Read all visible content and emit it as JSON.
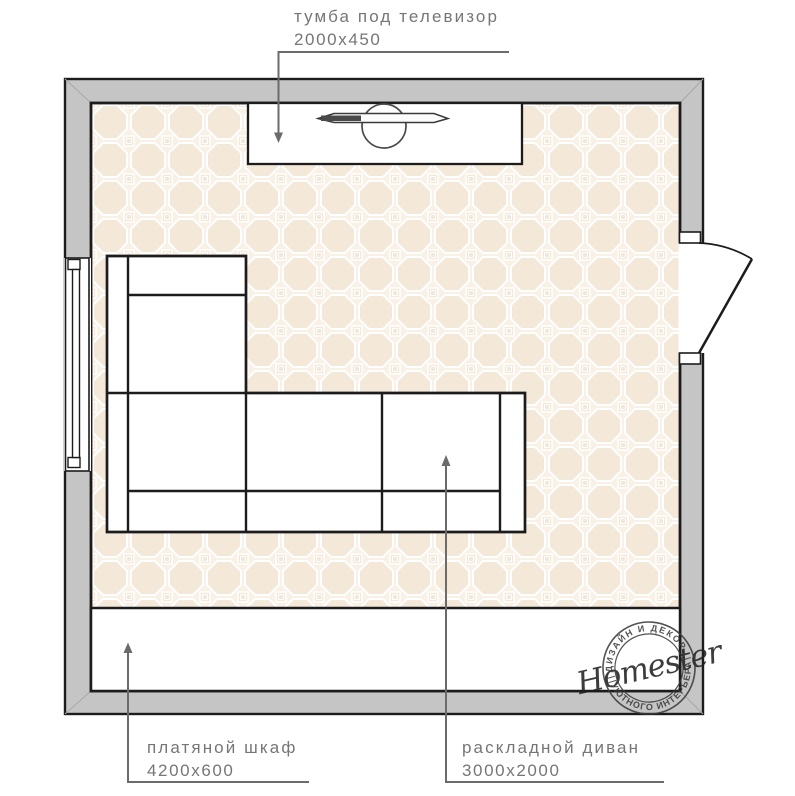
{
  "colors": {
    "wall_fill": "#c5c5c5",
    "outline": "#1c1c1c",
    "floor_base": "#f9f1e6",
    "floor_tile": "#f4e8d9",
    "pattern_line": "#ffffff",
    "leader": "#6b6b6b",
    "label_text": "#767676",
    "stamp_ink": "#3b3b3b"
  },
  "labels": {
    "tv_stand": {
      "name": "тумба под телевизор",
      "dimensions": "2000x450"
    },
    "wardrobe": {
      "name": "платяной шкаф",
      "dimensions": "4200x600"
    },
    "sofa": {
      "name": "раскладной диван",
      "dimensions": "3000x2000"
    }
  },
  "watermark": {
    "brand": "Homester",
    "arc_top": "ДИЗАЙН И ДЕКОР",
    "arc_bottom": "УЮТНОГО ИНТЕРЬЕРА"
  }
}
